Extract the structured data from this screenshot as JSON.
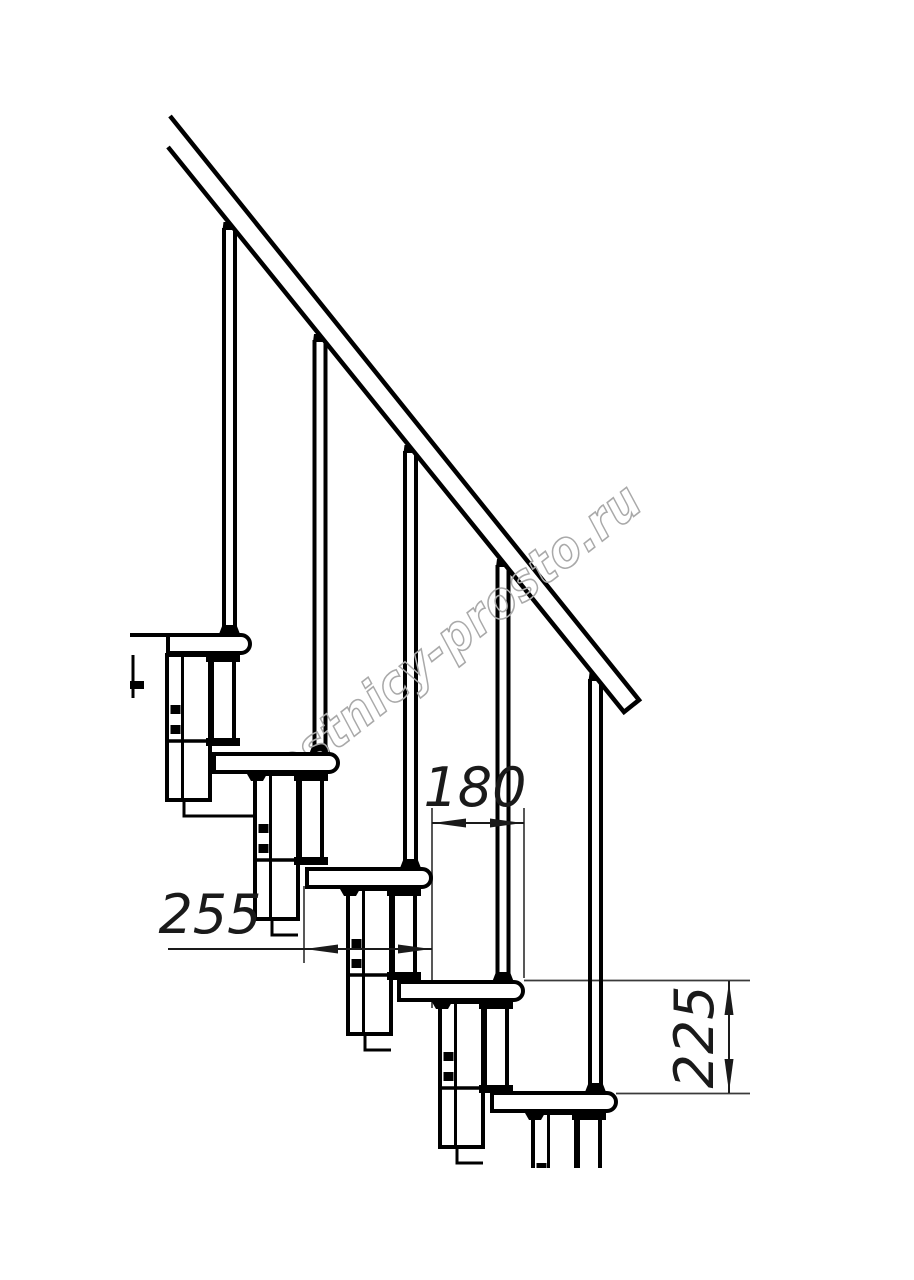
{
  "drawing": {
    "watermark_text": "lestnicy-prosto.ru",
    "dimensions": {
      "nosing_offset_mm": "180",
      "tread_depth_mm": "255",
      "step_rise_mm": "225"
    }
  },
  "colors": {
    "line": "#000000",
    "dimension": "#1a1a1a",
    "extension_line": "#3a3a3a",
    "watermark": "#a9a9a9",
    "background": "#ffffff"
  }
}
